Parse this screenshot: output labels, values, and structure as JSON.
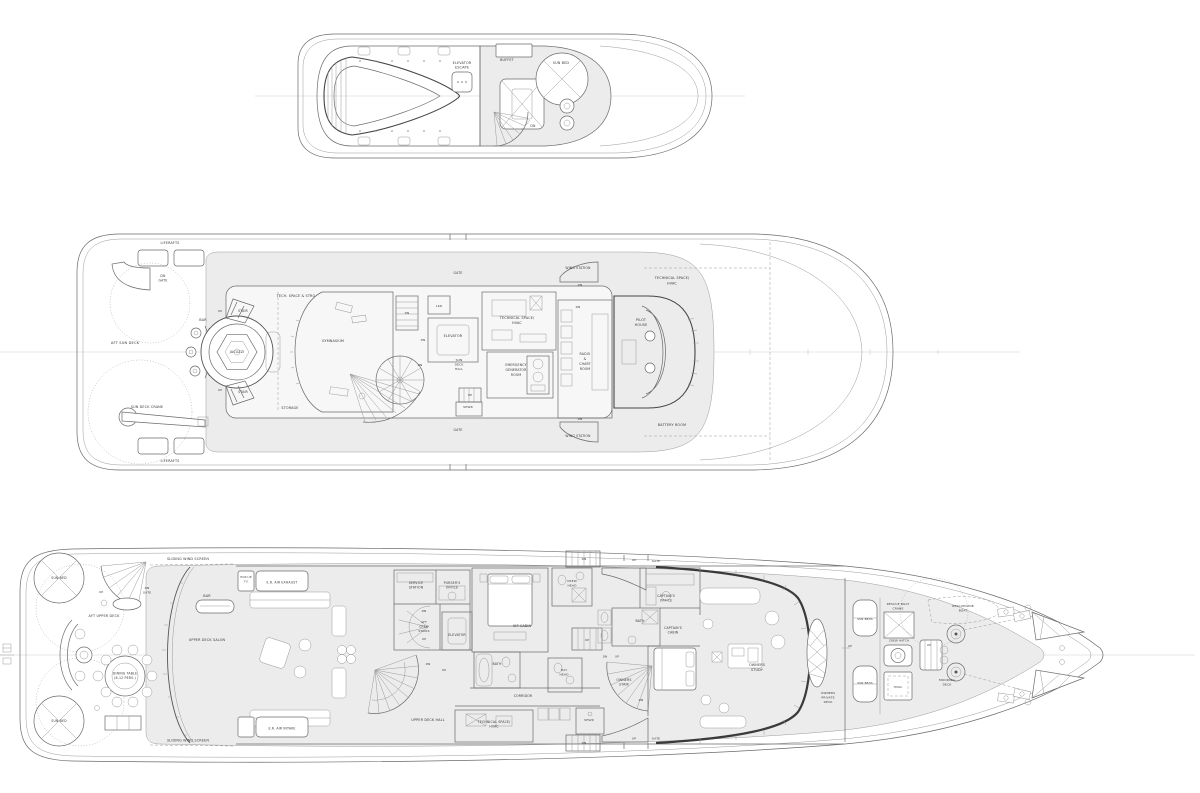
{
  "plan": {
    "title": "yacht-general-arrangement",
    "colors": {
      "line": "#6b6b6b",
      "shaded_deck": "#ececec",
      "centerline": "#cfcfcf",
      "text": "#3a3a3a",
      "paper": "#ffffff"
    },
    "decks": [
      {
        "id": "sun-deck-top",
        "labels": [
          {
            "t": "ELEVATOR",
            "x": 462,
            "y": 64,
            "s": 3.4
          },
          {
            "t": "ESCAPE",
            "x": 462,
            "y": 68.5,
            "s": 3.4
          },
          {
            "t": "BUFFET",
            "x": 507,
            "y": 61,
            "s": 3.4
          },
          {
            "t": "SUN BED",
            "x": 561,
            "y": 64,
            "s": 3.4
          },
          {
            "t": "DN",
            "x": 533,
            "y": 127,
            "s": 3.2
          }
        ]
      },
      {
        "id": "sun-deck",
        "labels": [
          {
            "t": "LIFERAFTS",
            "x": 170,
            "y": 244,
            "s": 3.4
          },
          {
            "t": "LIFERAFTS",
            "x": 170,
            "y": 462,
            "s": 3.4
          },
          {
            "t": "DN",
            "x": 163,
            "y": 277,
            "s": 3.2
          },
          {
            "t": "GATE",
            "x": 163,
            "y": 281.5,
            "s": 3.2
          },
          {
            "t": "AFT SUN DECK",
            "x": 125,
            "y": 344,
            "s": 3.6
          },
          {
            "t": "BAR",
            "x": 203,
            "y": 321,
            "s": 3.4
          },
          {
            "t": "UP",
            "x": 220,
            "y": 312,
            "s": 3
          },
          {
            "t": "STAIR",
            "x": 243,
            "y": 312,
            "s": 3.2
          },
          {
            "t": "UP",
            "x": 220,
            "y": 391,
            "s": 3
          },
          {
            "t": "STAIR",
            "x": 243,
            "y": 393,
            "s": 3.2
          },
          {
            "t": "JACUZZI",
            "x": 237,
            "y": 353,
            "s": 3.4
          },
          {
            "t": "SUN DECK CRANE",
            "x": 147,
            "y": 408,
            "s": 3.4
          },
          {
            "t": "TECH. SPACE & STRG",
            "x": 296,
            "y": 297,
            "s": 3.4
          },
          {
            "t": "STORAGE",
            "x": 290,
            "y": 409,
            "s": 3.4
          },
          {
            "t": "GYMNASIUM",
            "x": 333,
            "y": 342,
            "s": 3.4
          },
          {
            "t": "DN",
            "x": 407,
            "y": 314,
            "s": 3
          },
          {
            "t": "GATE",
            "x": 458,
            "y": 274,
            "s": 3.2
          },
          {
            "t": "GATE",
            "x": 458,
            "y": 431,
            "s": 3.2
          },
          {
            "t": "LKR",
            "x": 439,
            "y": 307,
            "s": 3
          },
          {
            "t": "ELEVATOR",
            "x": 453,
            "y": 337,
            "s": 3.4
          },
          {
            "t": "DN",
            "x": 423,
            "y": 341,
            "s": 3
          },
          {
            "t": "TECHNICAL SPACE/",
            "x": 517,
            "y": 319,
            "s": 3.4
          },
          {
            "t": "HVAC",
            "x": 517,
            "y": 324,
            "s": 3.4
          },
          {
            "t": "DN",
            "x": 420,
            "y": 366,
            "s": 3
          },
          {
            "t": "SUN",
            "x": 459,
            "y": 361,
            "s": 3
          },
          {
            "t": "DECK",
            "x": 459,
            "y": 365.5,
            "s": 3
          },
          {
            "t": "HALL",
            "x": 459,
            "y": 370,
            "s": 3
          },
          {
            "t": "EMERGENCY",
            "x": 516,
            "y": 366,
            "s": 3.2
          },
          {
            "t": "GENERATOR",
            "x": 516,
            "y": 371,
            "s": 3.2
          },
          {
            "t": "ROOM",
            "x": 516,
            "y": 376,
            "s": 3.2
          },
          {
            "t": "UP",
            "x": 470,
            "y": 396,
            "s": 3
          },
          {
            "t": "SHWR",
            "x": 468,
            "y": 408,
            "s": 3
          },
          {
            "t": "RADIO",
            "x": 585,
            "y": 355,
            "s": 3.2
          },
          {
            "t": "&",
            "x": 585,
            "y": 360,
            "s": 3.2
          },
          {
            "t": "CHART",
            "x": 585,
            "y": 365,
            "s": 3.2
          },
          {
            "t": "ROOM",
            "x": 585,
            "y": 370,
            "s": 3.2
          },
          {
            "t": "PILOT",
            "x": 641,
            "y": 321,
            "s": 3.4
          },
          {
            "t": "HOUSE",
            "x": 641,
            "y": 326,
            "s": 3.4
          },
          {
            "t": "WING STATION",
            "x": 578,
            "y": 269,
            "s": 3.2
          },
          {
            "t": "DN",
            "x": 580,
            "y": 286,
            "s": 3
          },
          {
            "t": "DN",
            "x": 578,
            "y": 308,
            "s": 3
          },
          {
            "t": "WING STATION",
            "x": 578,
            "y": 437,
            "s": 3.2
          },
          {
            "t": "DN",
            "x": 580,
            "y": 420,
            "s": 3
          },
          {
            "t": "TECHNICAL SPACE/",
            "x": 672,
            "y": 279,
            "s": 3.4
          },
          {
            "t": "HVAC",
            "x": 672,
            "y": 284.5,
            "s": 3.4
          },
          {
            "t": "BATTERY ROOM",
            "x": 672,
            "y": 426,
            "s": 3.4
          }
        ]
      },
      {
        "id": "upper-deck",
        "labels": [
          {
            "t": "SUN BED",
            "x": 59,
            "y": 579,
            "s": 3.2
          },
          {
            "t": "SUN BED",
            "x": 59,
            "y": 722,
            "s": 3.2
          },
          {
            "t": "UP",
            "x": 101,
            "y": 593,
            "s": 3
          },
          {
            "t": "DN",
            "x": 147,
            "y": 589,
            "s": 3
          },
          {
            "t": "GATE",
            "x": 147,
            "y": 593.5,
            "s": 3
          },
          {
            "t": "SLIDING WIND SCREEN",
            "x": 188,
            "y": 560,
            "s": 3.4
          },
          {
            "t": "SLIDING WIND SCREEN",
            "x": 188,
            "y": 741.5,
            "s": 3.4
          },
          {
            "t": "AFT UPPER DECK",
            "x": 104,
            "y": 617,
            "s": 3.4
          },
          {
            "t": "DINING TABLE",
            "x": 125,
            "y": 674.5,
            "s": 3.2
          },
          {
            "t": "(8-12 PERS.)",
            "x": 125,
            "y": 679,
            "s": 3.2
          },
          {
            "t": "POP-UP",
            "x": 246,
            "y": 578,
            "s": 2.8
          },
          {
            "t": "TV",
            "x": 246,
            "y": 582.5,
            "s": 2.8
          },
          {
            "t": "E.R. AIR EXHAUST",
            "x": 282,
            "y": 583.5,
            "s": 3.2
          },
          {
            "t": "E.R. AIR INTAKE",
            "x": 282,
            "y": 729.5,
            "s": 3.2
          },
          {
            "t": "BAR",
            "x": 207,
            "y": 597,
            "s": 3.4
          },
          {
            "t": "UPPER DECK SALON",
            "x": 207,
            "y": 641,
            "s": 3.4
          },
          {
            "t": "SERVICE",
            "x": 416,
            "y": 584,
            "s": 3.2
          },
          {
            "t": "STATION",
            "x": 416,
            "y": 588.5,
            "s": 3.2
          },
          {
            "t": "PURSER'S",
            "x": 452,
            "y": 584,
            "s": 3.2
          },
          {
            "t": "OFFICE",
            "x": 452,
            "y": 588.5,
            "s": 3.2
          },
          {
            "t": "DN",
            "x": 424,
            "y": 612,
            "s": 3
          },
          {
            "t": "AFT",
            "x": 424,
            "y": 623,
            "s": 3
          },
          {
            "t": "CREW",
            "x": 424,
            "y": 627.5,
            "s": 3
          },
          {
            "t": "STAIRS",
            "x": 424,
            "y": 632,
            "s": 3
          },
          {
            "t": "UP",
            "x": 424,
            "y": 640,
            "s": 3
          },
          {
            "t": "ELEVATOR",
            "x": 457,
            "y": 636,
            "s": 3.2
          },
          {
            "t": "VIP CABIN",
            "x": 522,
            "y": 627,
            "s": 3.4
          },
          {
            "t": "BATH",
            "x": 497,
            "y": 665,
            "s": 3.2
          },
          {
            "t": "CREW",
            "x": 572,
            "y": 582,
            "s": 3
          },
          {
            "t": "HEAD",
            "x": 572,
            "y": 586.5,
            "s": 3
          },
          {
            "t": "DN",
            "x": 584,
            "y": 560,
            "s": 3
          },
          {
            "t": "UP",
            "x": 587,
            "y": 641,
            "s": 3
          },
          {
            "t": "DAY",
            "x": 564,
            "y": 671,
            "s": 3
          },
          {
            "t": "HEAD",
            "x": 564,
            "y": 675.5,
            "s": 3
          },
          {
            "t": "CORRIDOR",
            "x": 523,
            "y": 697,
            "s": 3.2
          },
          {
            "t": "DN",
            "x": 428,
            "y": 665,
            "s": 3
          },
          {
            "t": "UP",
            "x": 444,
            "y": 671,
            "s": 3
          },
          {
            "t": "UPPER DECK HALL",
            "x": 428,
            "y": 721,
            "s": 3.4
          },
          {
            "t": "TECHNICAL SPACE/",
            "x": 494,
            "y": 723,
            "s": 3.2
          },
          {
            "t": "HVAC",
            "x": 494,
            "y": 727.5,
            "s": 3.2
          },
          {
            "t": "SHWR",
            "x": 589,
            "y": 721,
            "s": 3
          },
          {
            "t": "DN",
            "x": 584,
            "y": 744,
            "s": 3
          },
          {
            "t": "UP",
            "x": 634,
            "y": 561,
            "s": 3
          },
          {
            "t": "GATE",
            "x": 656,
            "y": 562,
            "s": 3
          },
          {
            "t": "UP",
            "x": 634,
            "y": 739.5,
            "s": 3
          },
          {
            "t": "GATE",
            "x": 656,
            "y": 739.5,
            "s": 3
          },
          {
            "t": "CAPTAIN'S",
            "x": 666,
            "y": 597,
            "s": 3.2
          },
          {
            "t": "OFFICE",
            "x": 666,
            "y": 601.5,
            "s": 3.2
          },
          {
            "t": "BATH",
            "x": 640,
            "y": 622,
            "s": 3.2
          },
          {
            "t": "CAPTAIN'S",
            "x": 673,
            "y": 629,
            "s": 3.2
          },
          {
            "t": "CABIN",
            "x": 673,
            "y": 633.5,
            "s": 3.2
          },
          {
            "t": "DN",
            "x": 605,
            "y": 657.5,
            "s": 2.8
          },
          {
            "t": "UP",
            "x": 617,
            "y": 657.5,
            "s": 2.8
          },
          {
            "t": "OWNERS",
            "x": 624,
            "y": 681,
            "s": 3.2
          },
          {
            "t": "STAIR",
            "x": 624,
            "y": 685.5,
            "s": 3.2
          },
          {
            "t": "DN",
            "x": 641,
            "y": 701,
            "s": 3
          },
          {
            "t": "OWNERS",
            "x": 757,
            "y": 666,
            "s": 3.4
          },
          {
            "t": "STUDY",
            "x": 757,
            "y": 671,
            "s": 3.4
          },
          {
            "t": "OWNERS",
            "x": 828,
            "y": 694,
            "s": 3
          },
          {
            "t": "PRIVATE",
            "x": 828,
            "y": 698.5,
            "s": 3
          },
          {
            "t": "DECK",
            "x": 828,
            "y": 703,
            "s": 3
          },
          {
            "t": "RESCUE BOAT",
            "x": 898,
            "y": 605,
            "s": 3
          },
          {
            "t": "CRANE",
            "x": 898,
            "y": 609.5,
            "s": 3
          },
          {
            "t": "SUN BEDS",
            "x": 865,
            "y": 620,
            "s": 2.8
          },
          {
            "t": "SUN BEDS",
            "x": 865,
            "y": 684,
            "s": 2.8
          },
          {
            "t": "CREW HATCH",
            "x": 899,
            "y": 641.5,
            "s": 2.8
          },
          {
            "t": "UP",
            "x": 850,
            "y": 647,
            "s": 2.8
          },
          {
            "t": "UP",
            "x": 929,
            "y": 646,
            "s": 2.8
          },
          {
            "t": "RESCUE/MOB",
            "x": 963,
            "y": 607,
            "s": 3
          },
          {
            "t": "BOAT",
            "x": 963,
            "y": 611.5,
            "s": 3
          },
          {
            "t": "MOORING",
            "x": 947,
            "y": 681,
            "s": 3
          },
          {
            "t": "DECK",
            "x": 947,
            "y": 685.5,
            "s": 3
          },
          {
            "t": "HVAC",
            "x": 898,
            "y": 688,
            "s": 3
          }
        ]
      }
    ]
  }
}
